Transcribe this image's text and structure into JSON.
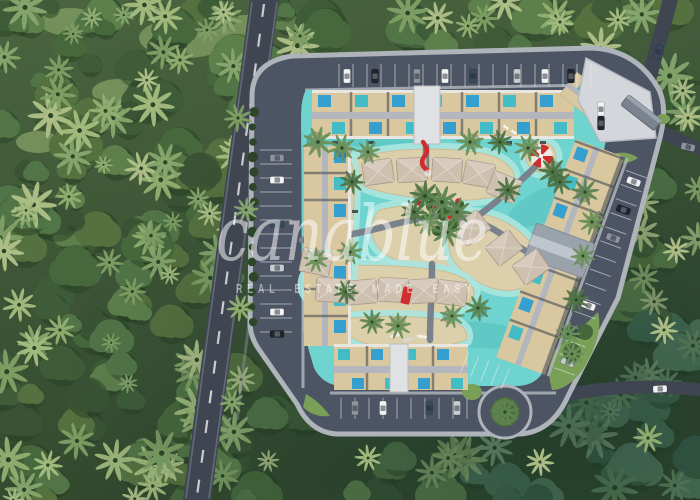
{
  "watermark": {
    "brand": "canablue",
    "tagline": "REAL ESTATE MADE EASY"
  },
  "scene": {
    "type": "aerial-3d-render",
    "subject": "Top-down masterplan render of a tropical lagoon resort surrounded by dense palm forest",
    "features": [
      "perimeter road with perpendicular parking and cars",
      "turquoise lagoon with sandy islands",
      "thatched-roof bungalows",
      "apartment wings with rows of small private pools",
      "central palm island with red parasols",
      "red water slide and red foot bridge",
      "large red and white beach parasol",
      "entrance plaza with gate canopy",
      "roundabout with green island",
      "diagonal highway with dashed centerline",
      "palm forest surrounding the site"
    ]
  },
  "palette": {
    "forest": "#4a6540",
    "forest_dark": "#32482d",
    "road": "#3f4551",
    "complex_pavement": "#4d5464",
    "sidewalk": "#aeb4ba",
    "lagoon": "#6fd3cf",
    "lagoon_shallow": "#abe6df",
    "sand": "#dccfab",
    "hut_roof": "#cdc0af",
    "building_beige": "#d9c7a0",
    "building_glass": "#3c434e",
    "corridor_gray": "#b3b7bd",
    "pool_teal": "#44bcc6",
    "pool_blue": "#359fd0",
    "accent_red": "#cf2e2e",
    "grass": "#7aa057",
    "plaza": "#d3d6da",
    "clubhouse": "#9aa2ac",
    "watermark": "#ffffff"
  }
}
